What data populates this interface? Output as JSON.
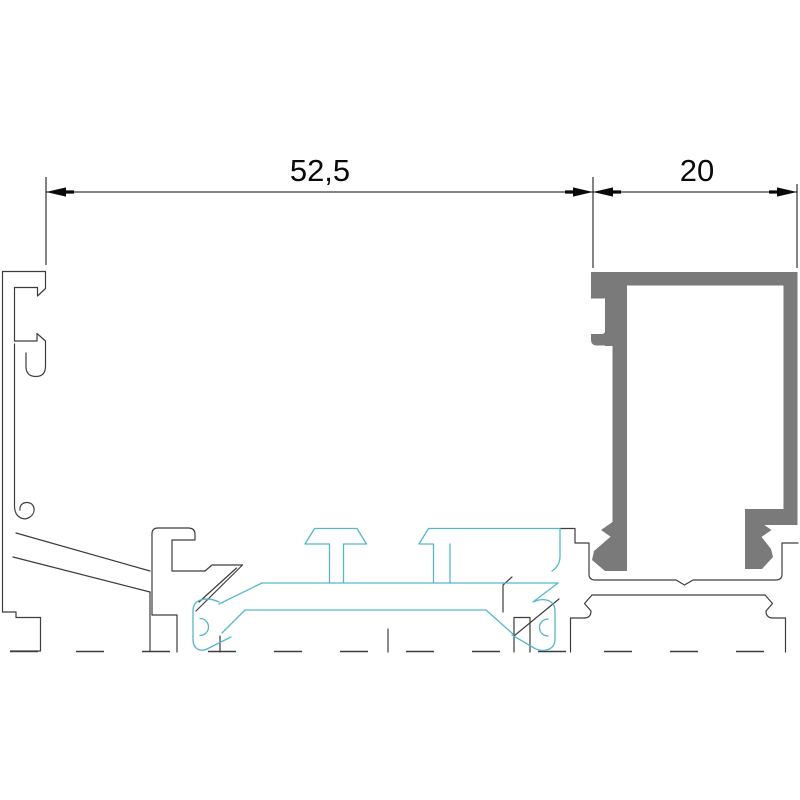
{
  "drawing": {
    "kind": "aluminium-profile-cross-section",
    "dimensions": {
      "main_width": {
        "label": "52,5"
      },
      "cover_width": {
        "label": "20"
      }
    },
    "colors": {
      "background": "#ffffff",
      "profile_outline": "#3d3d3d",
      "dimension": "#0a0a0a",
      "gasket": "#58b6cc",
      "cover_fill": "#7a7a7a"
    }
  }
}
